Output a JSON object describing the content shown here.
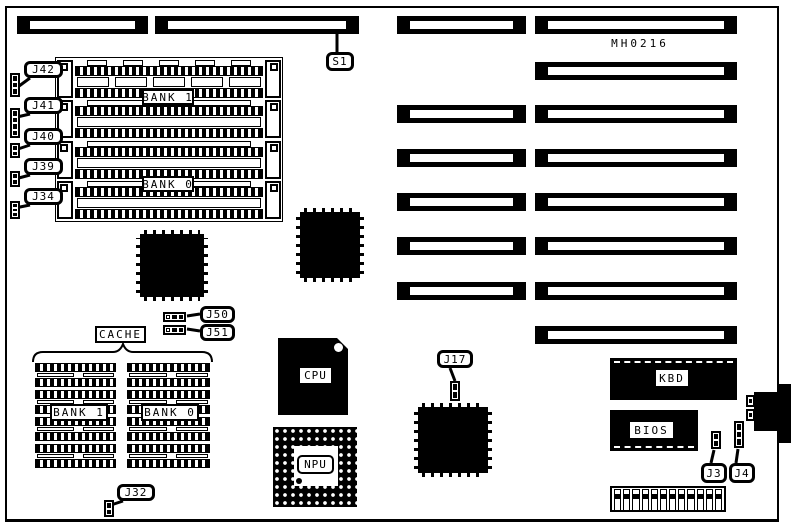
{
  "board": {
    "model": "MH0216"
  },
  "labels": {
    "s1": "S1",
    "j42": "J42",
    "j41": "J41",
    "j40": "J40",
    "j39": "J39",
    "j34": "J34",
    "j50": "J50",
    "j51": "J51",
    "j17": "J17",
    "j3": "J3",
    "j4": "J4",
    "j32": "J32",
    "cache": "CACHE",
    "mem_bank1": "BANK 1",
    "mem_bank0": "BANK 0",
    "cache_bank1": "BANK 1",
    "cache_bank0": "BANK 0",
    "cpu": "CPU",
    "npu": "NPU",
    "kbd": "KBD",
    "bios": "BIOS"
  },
  "colors": {
    "ink": "#000000",
    "paper": "#ffffff"
  }
}
